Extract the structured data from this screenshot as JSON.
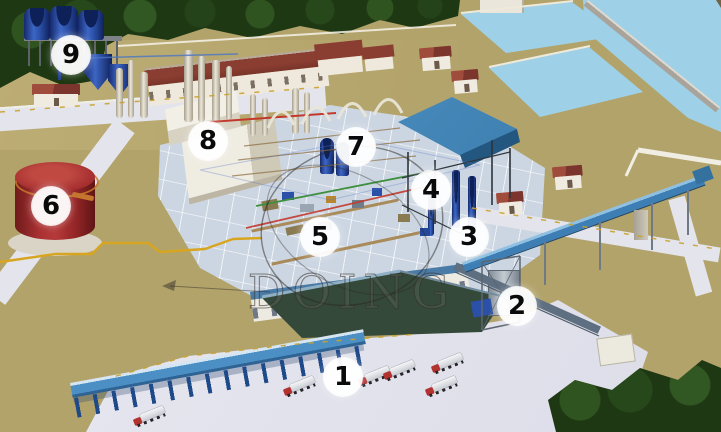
{
  "watermark": {
    "text": "DOING"
  },
  "markers": [
    {
      "label": "1",
      "x": 343,
      "y": 377
    },
    {
      "label": "2",
      "x": 517,
      "y": 306
    },
    {
      "label": "3",
      "x": 469,
      "y": 237
    },
    {
      "label": "4",
      "x": 431,
      "y": 190
    },
    {
      "label": "5",
      "x": 320,
      "y": 237
    },
    {
      "label": "6",
      "x": 51,
      "y": 206
    },
    {
      "label": "7",
      "x": 356,
      "y": 147
    },
    {
      "label": "8",
      "x": 208,
      "y": 141
    },
    {
      "label": "9",
      "x": 71,
      "y": 55
    }
  ],
  "trucks": [
    {
      "x": 133,
      "y": 411,
      "r": -22
    },
    {
      "x": 283,
      "y": 381,
      "r": -22
    },
    {
      "x": 358,
      "y": 371,
      "r": -22
    },
    {
      "x": 383,
      "y": 365,
      "r": -22
    },
    {
      "x": 431,
      "y": 358,
      "r": -22
    },
    {
      "x": 425,
      "y": 381,
      "r": -22
    }
  ],
  "colors": {
    "ground": "#b2a36b",
    "trees": "#1e3813",
    "water": "#9ed1e8",
    "pavement": "#e4e4ec",
    "tank_red": "#a93031",
    "tank_blue": "#2a50a8",
    "conveyor_blue": "#3d7fb5",
    "roof_red": "#8a3d31",
    "marker_text": "#0a0a0a",
    "truck_cab": "#b23230",
    "watermark_color": "rgba(50,46,40,0.55)"
  }
}
